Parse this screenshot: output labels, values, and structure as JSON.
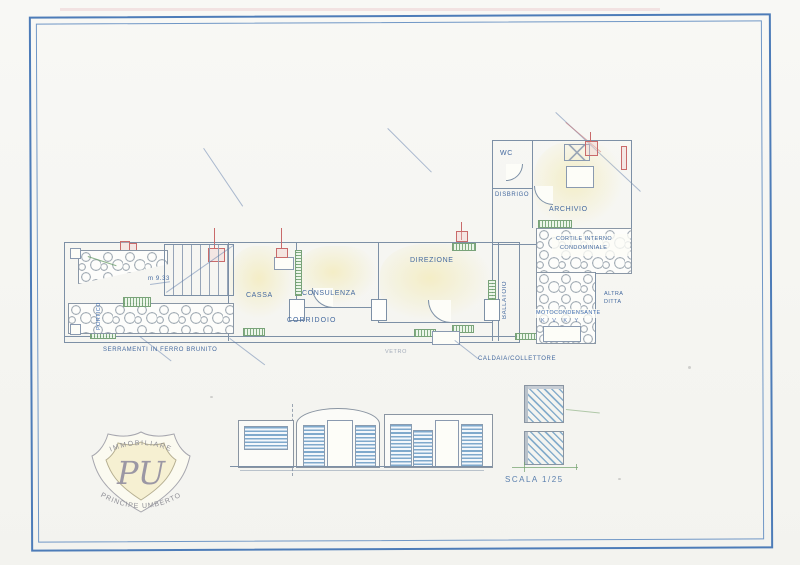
{
  "colors": {
    "frame_blue": "#4d7cb8",
    "wall_gray": "#7d90a6",
    "label_blue": "#44699f",
    "annotation_red": "#c96a6a",
    "fixture_green": "#6f9a6f",
    "floor_tint_yellow": "#f2e9af"
  },
  "plan": {
    "room_labels": {
      "cassa": "CASSA",
      "consulenza": "CONSULENZA",
      "corridoio": "CORRIDOIO",
      "direzione": "DIREZIONE",
      "ballatoio": "BALLATOIO",
      "wc": "WC",
      "disbrigo": "DISBRIGO",
      "archivio": "ARCHIVIO",
      "portico": "PORTICO",
      "cortile_line1": "CORTILE INTERNO",
      "cortile_line2": "CONDOMINIALE",
      "altra_line1": "ALTRA",
      "altra_line2": "DITTA",
      "motocondensante": "MOTOCONDENSANTE",
      "motocondensante_sub": "K V K Y"
    },
    "dimension_note": "m 9.33",
    "annotations": {
      "serramenti": "SERRAMENTI IN FERRO BRUNITO",
      "vetro": "VETRO",
      "caldaia": "CALDAIA/COLLETTORE"
    }
  },
  "details": {
    "scale_label": "SCALA 1/25"
  },
  "logo": {
    "arc_top": "IMMOBILIARE",
    "monogram": "PU",
    "arc_bottom": "PRINCIPE UMBERTO"
  }
}
